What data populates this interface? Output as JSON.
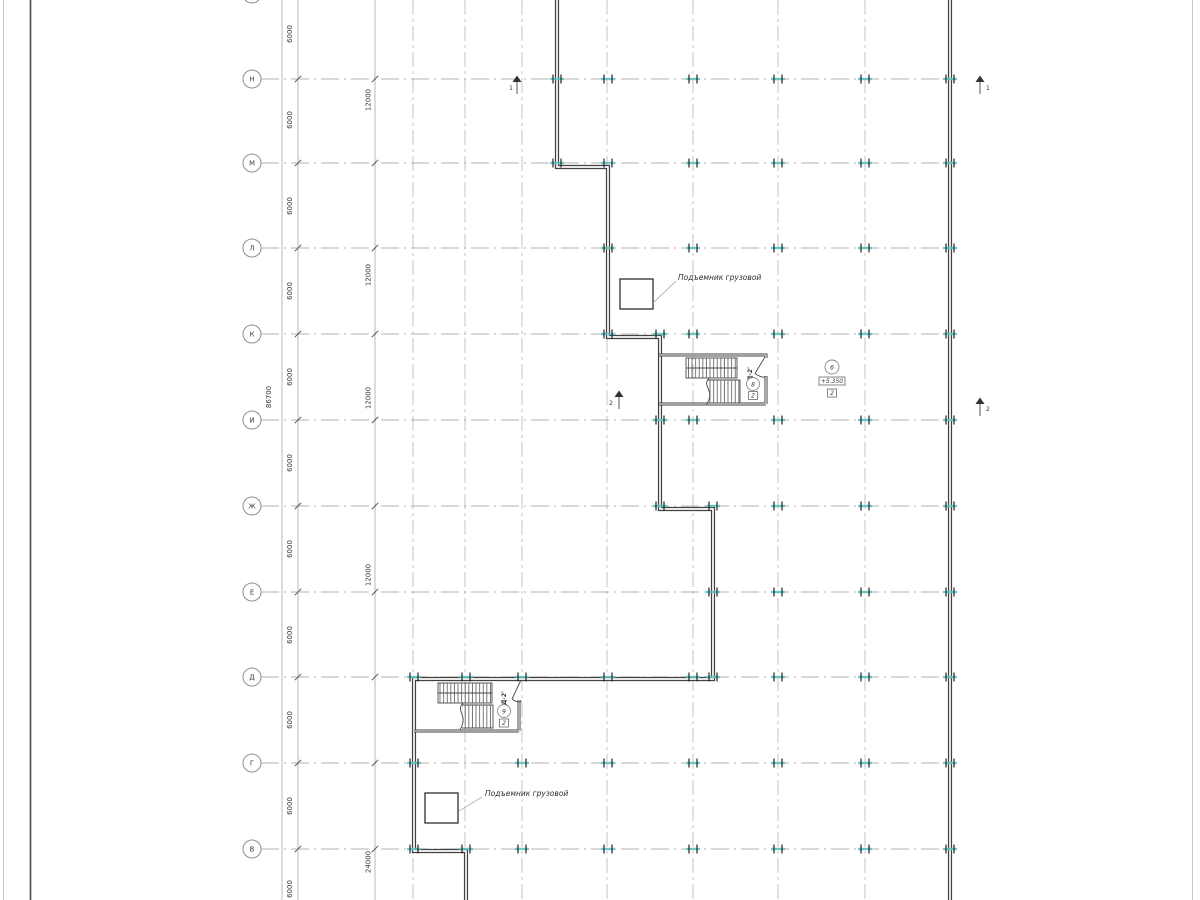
{
  "drawing": {
    "type": "floor-plan",
    "axis_rows": [
      {
        "label": "Н"
      },
      {
        "label": "М"
      },
      {
        "label": "Л"
      },
      {
        "label": "К"
      },
      {
        "label": "И"
      },
      {
        "label": "Ж"
      },
      {
        "label": "Е"
      },
      {
        "label": "Д"
      },
      {
        "label": "Г"
      },
      {
        "label": "В"
      }
    ],
    "dims": {
      "bay": "6000",
      "double_bay": "12000",
      "quad_bay": "24000",
      "total": "86700"
    },
    "annotations": {
      "freight_lift_upper": "Подъемник грузовой",
      "freight_lift_lower": "Подъемник грузовой"
    },
    "callouts": {
      "upper_stair": {
        "door": "Д-2'",
        "detail": "8",
        "sheet": "2"
      },
      "lower_stair": {
        "door": "Д-2'",
        "detail": "9",
        "sheet": "2"
      },
      "level": {
        "detail": "6",
        "elevation": "+5.350",
        "sheet": "2"
      }
    },
    "sections": {
      "one": "1",
      "two": "2"
    },
    "colors": {
      "wall": "#414141",
      "grid": "#b8b8b8",
      "axis_line": "#9a9a9a",
      "dim_text": "#3a3a3a",
      "column_tick": "#5bc4c4"
    }
  }
}
